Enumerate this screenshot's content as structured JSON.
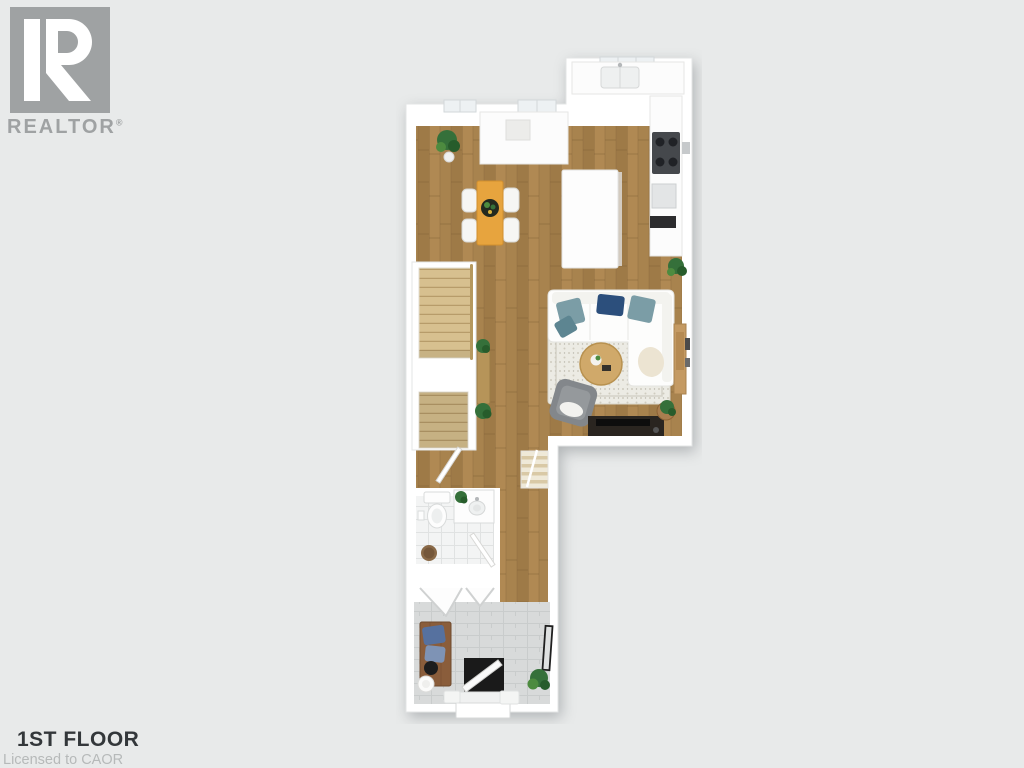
{
  "branding": {
    "logo_letter": "R",
    "logo_text": "REALTOR",
    "registered_mark": "®"
  },
  "footer": {
    "title": "1ST FLOOR",
    "license": "Licensed to CAOR"
  },
  "colors": {
    "bg": "#e8eaea",
    "logoGray": "#9fa2a3",
    "titleDark": "#33373a",
    "licenseGray": "#b6b9b9",
    "wall": "#ffffff",
    "wallEdge": "#e3e5e5",
    "wood": "#a8834e",
    "woodDark": "#8f6b3d",
    "woodLight": "#b58e58",
    "stair": "#d7c08f",
    "stairLine": "#b79c6a",
    "railing": "#b5985e",
    "bathTile": "#f3f4f4",
    "tileLine": "#e0e2e2",
    "entryTile": "#d8dada",
    "entryTileLine": "#c9cccc",
    "table": "#e7a43e",
    "chair": "#f6f6f4",
    "island": "#fdfdfd",
    "counter": "#fcfcfc",
    "stove": "#45484c",
    "appliance": "#2c2c2e",
    "sofa": "#fdfdfc",
    "pillowTeal": "#7b9da6",
    "pillowTeal2": "#5d8591",
    "pillowNavy": "#2c4f7c",
    "throw": "#ece4d2",
    "rug": "#ecebe4",
    "rugDot": "#cfccc0",
    "coffeeTable": "#d0a96a",
    "armchair": "#83878b",
    "tvConsole": "#2a2520",
    "tv": "#0d0d0d",
    "cabinetTan": "#c49a63",
    "plant": "#35703a",
    "plantDark": "#275c2b",
    "plantLight": "#4d8b3f",
    "bench": "#8a5d3b",
    "benchPillow": "#56719f",
    "benchPillow2": "#7e93b5",
    "door": "#1a1a1a",
    "mirror": "#1f1f1f",
    "basket": "#8a6a48",
    "consoleTable": "#b69459",
    "fixture": "#fdfdfd",
    "fixtureEdge": "#d9dbdb",
    "window": "#edf1f3",
    "windowEdge": "#d2d7d9"
  }
}
